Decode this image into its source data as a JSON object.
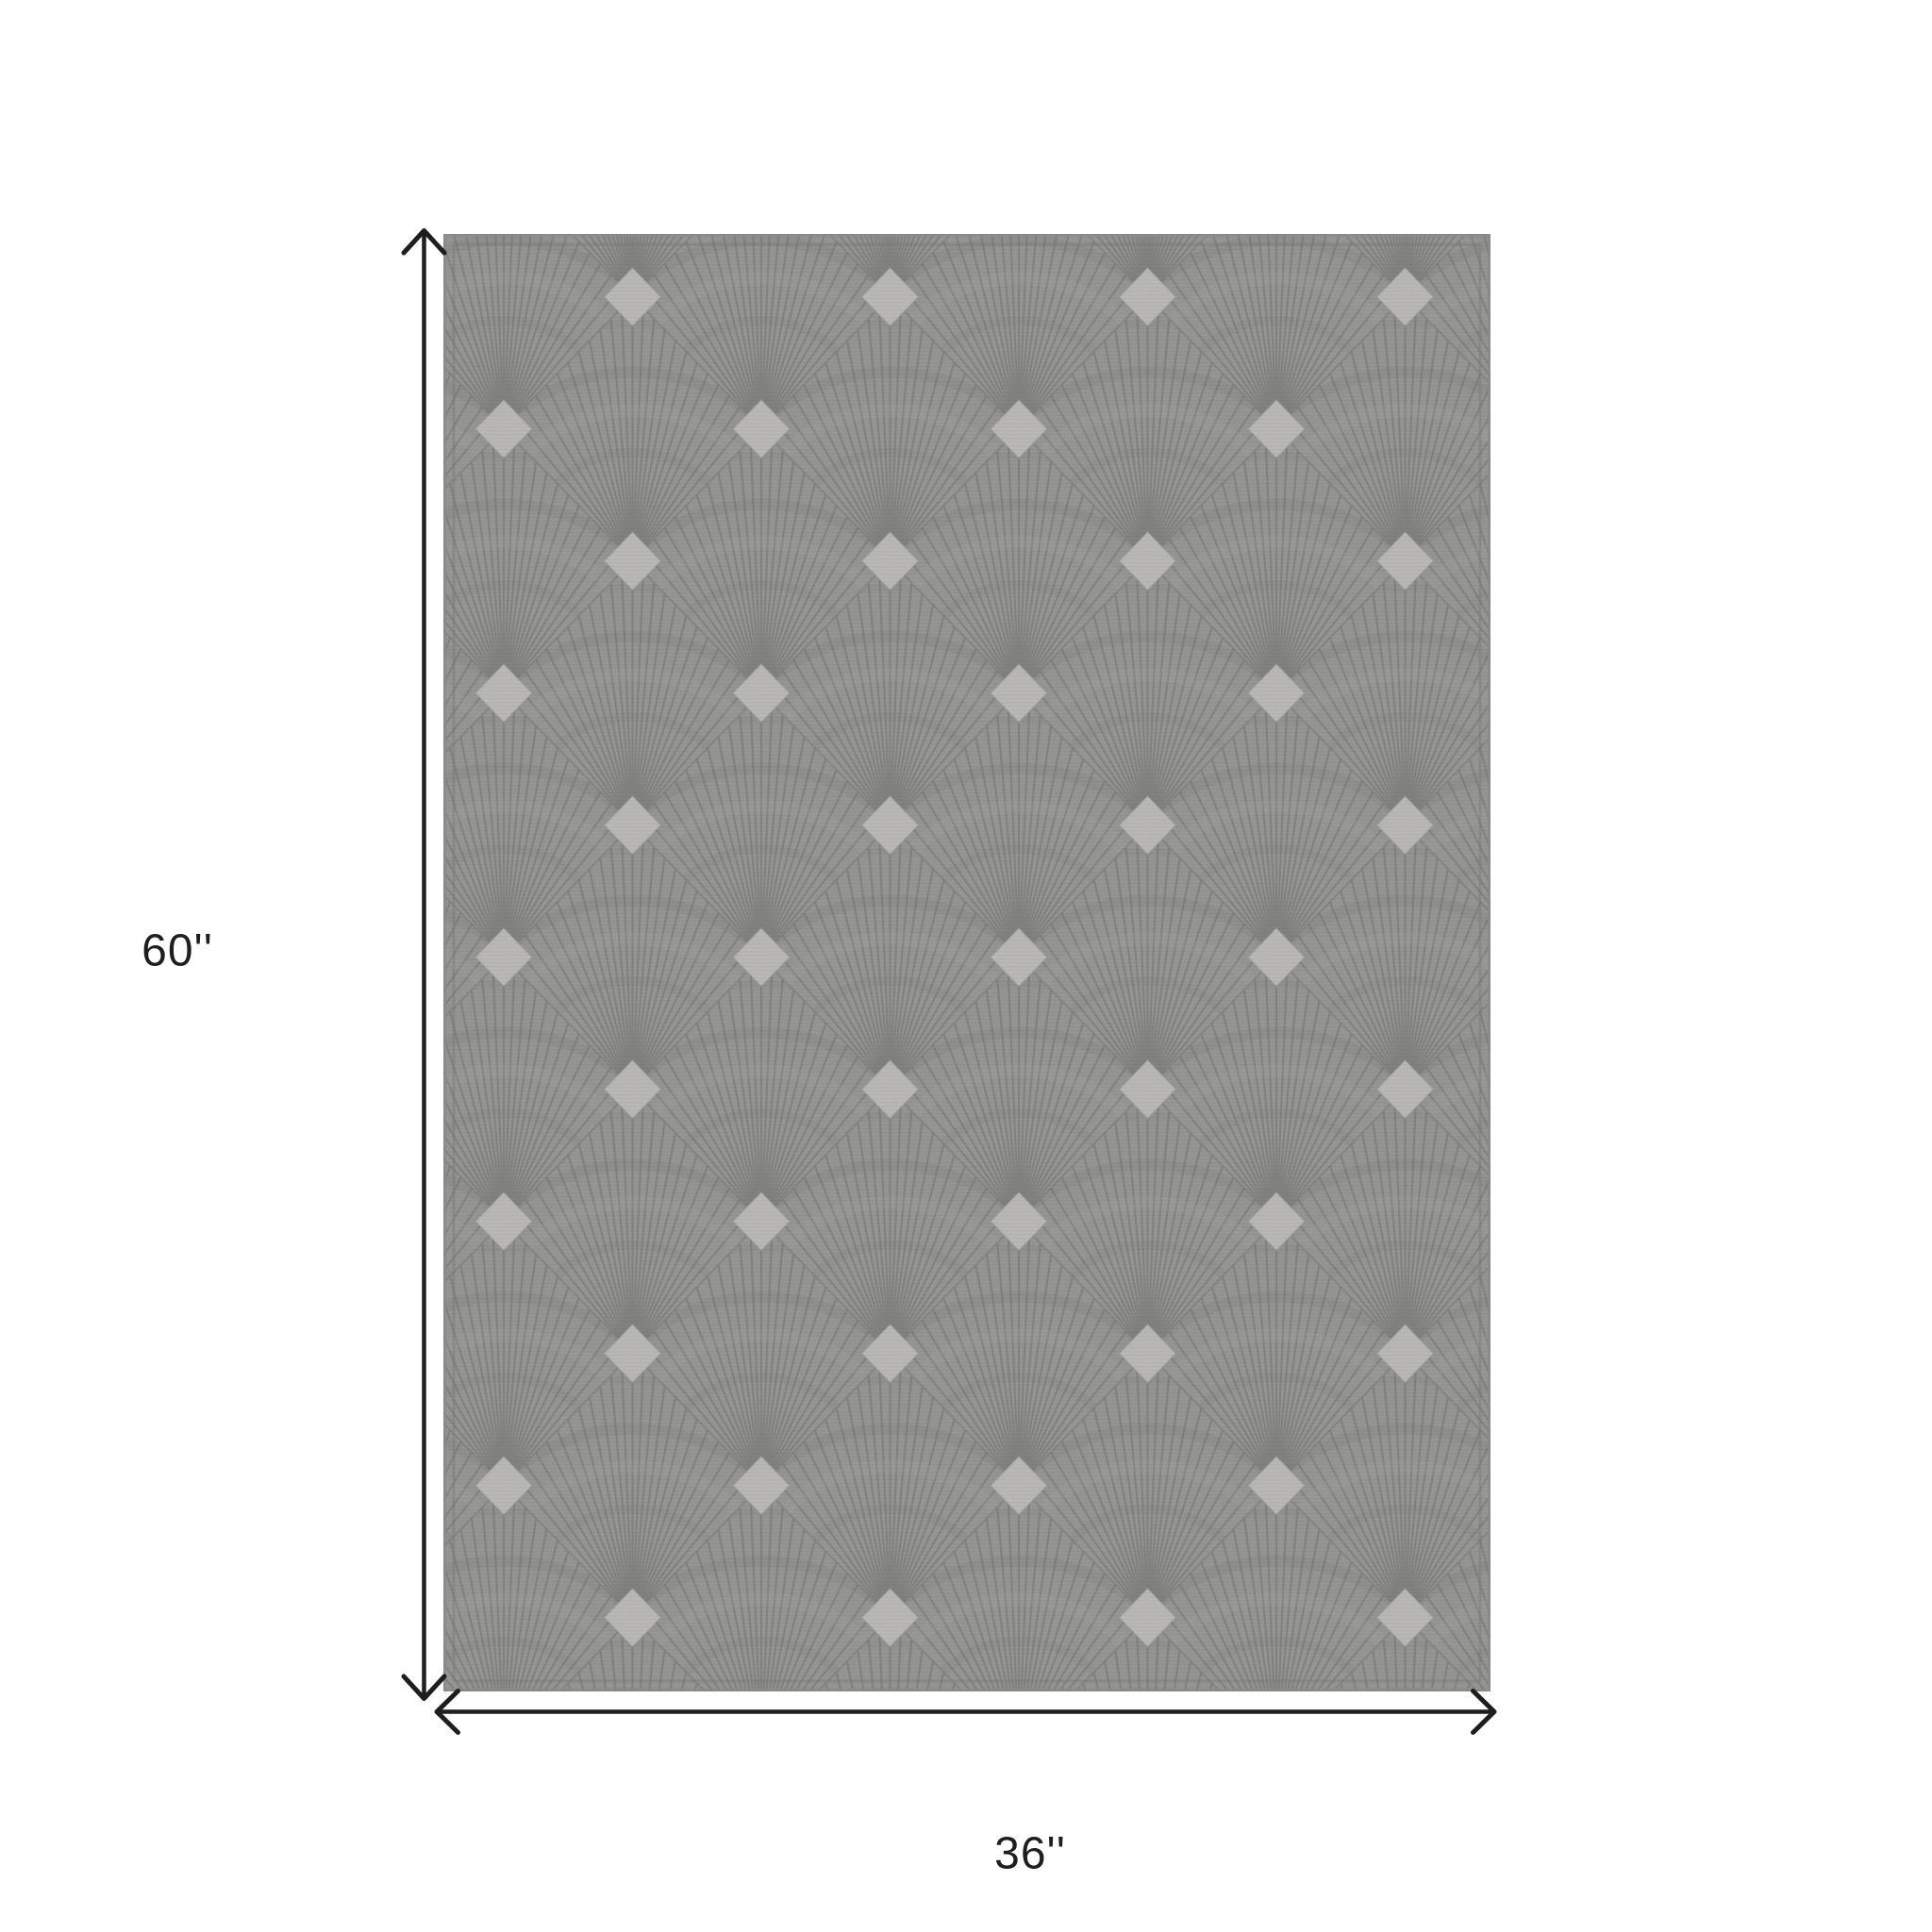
{
  "scene": {
    "background_color": "#ffffff",
    "description": "Product dimension diagram of a rectangular gray area rug shown flat in portrait orientation, annotated with a vertical height arrow and a horizontal width arrow."
  },
  "rug": {
    "pattern_name": "art deco fan / scallop lattice with ivory diamond accents",
    "base_color": "#a2a29f",
    "accent_color": "#e9e8e3",
    "ray_color": "#5c5c5a",
    "border_color": "#8a8a88",
    "stitch_color": "#767674"
  },
  "dimensions": {
    "height_label": "60''",
    "width_label": "36''"
  },
  "annotation": {
    "color": "#1e1e1e"
  }
}
